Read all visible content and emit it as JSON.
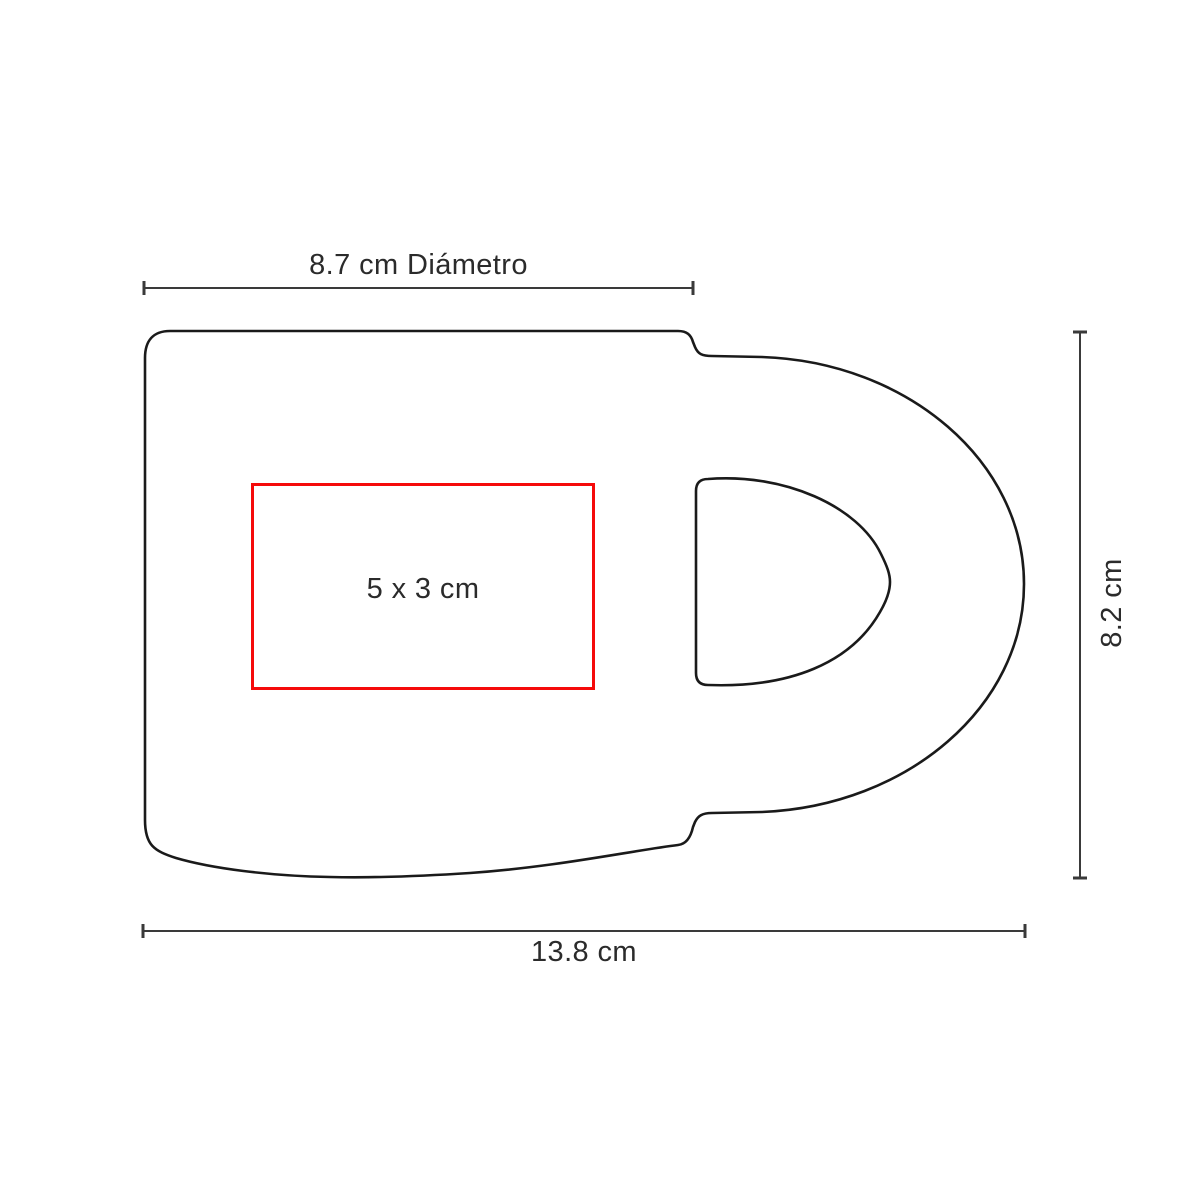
{
  "diagram": {
    "dimensions": {
      "diameter_label": "8.7 cm Diámetro",
      "height_label": "8.2 cm",
      "width_label": "13.8 cm"
    },
    "print_area_label": "5 x 3 cm"
  },
  "colors": {
    "outline": "#1a1a1a",
    "dimension_line": "#3a3a3a",
    "print_area": "#f50a0a",
    "text": "#2b2b2b"
  }
}
